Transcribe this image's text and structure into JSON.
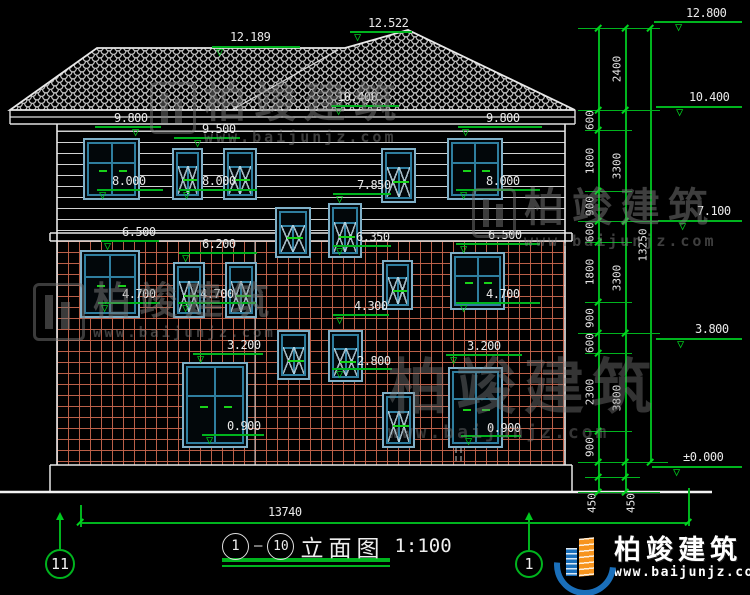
{
  "watermark": {
    "brand": "柏竣建筑",
    "url": "www.baijunjz.com"
  },
  "logo": {
    "brand": "柏竣建筑",
    "url": "www.baijunjz.com"
  },
  "title": {
    "axis_start": "1",
    "axis_end": "10",
    "name": "立面图",
    "scale": "1:100"
  },
  "axis_bubbles": {
    "left": "11",
    "right": "1"
  },
  "bottom_dimension": {
    "value": "13740"
  },
  "level_markers": [
    {
      "v": "12.522",
      "tx": 368,
      "ty": 16,
      "lx": 350,
      "lw": 62,
      "ly": 31,
      "dx": 354
    },
    {
      "v": "12.189",
      "tx": 230,
      "ty": 30,
      "lx": 212,
      "lw": 88,
      "ly": 46,
      "dx": 216
    },
    {
      "v": "10.400",
      "tx": 337,
      "ty": 90,
      "lx": 331,
      "lw": 68,
      "ly": 105,
      "dx": 335
    },
    {
      "v": "9.800",
      "tx": 114,
      "ty": 111,
      "lx": 95,
      "lw": 66,
      "ly": 126,
      "dx": 132
    },
    {
      "v": "9.500",
      "tx": 202,
      "ty": 122,
      "lx": 174,
      "lw": 66,
      "ly": 137,
      "dx": 194
    },
    {
      "v": "9.800",
      "tx": 486,
      "ty": 111,
      "lx": 458,
      "lw": 84,
      "ly": 126,
      "dx": 462
    },
    {
      "v": "8.000",
      "tx": 112,
      "ty": 174,
      "lx": 97,
      "lw": 66,
      "ly": 189,
      "dx": 99
    },
    {
      "v": "8.000",
      "tx": 202,
      "ty": 174,
      "lx": 179,
      "lw": 78,
      "ly": 189,
      "dx": 183
    },
    {
      "v": "8.000",
      "tx": 486,
      "ty": 174,
      "lx": 456,
      "lw": 84,
      "ly": 189,
      "dx": 460
    },
    {
      "v": "7.850",
      "tx": 357,
      "ty": 178,
      "lx": 333,
      "lw": 58,
      "ly": 193,
      "dx": 336
    },
    {
      "v": "6.500",
      "tx": 122,
      "ty": 225,
      "lx": 101,
      "lw": 58,
      "ly": 240,
      "dx": 104
    },
    {
      "v": "6.500",
      "tx": 488,
      "ty": 228,
      "lx": 456,
      "lw": 84,
      "ly": 243,
      "dx": 460
    },
    {
      "v": "6.200",
      "tx": 202,
      "ty": 237,
      "lx": 179,
      "lw": 78,
      "ly": 252,
      "dx": 182
    },
    {
      "v": "6.350",
      "tx": 356,
      "ty": 230,
      "lx": 333,
      "lw": 58,
      "ly": 245,
      "dx": 336
    },
    {
      "v": "4.700",
      "tx": 122,
      "ty": 287,
      "lx": 98,
      "lw": 62,
      "ly": 302,
      "dx": 101
    },
    {
      "v": "4.700",
      "tx": 200,
      "ty": 287,
      "lx": 178,
      "lw": 78,
      "ly": 302,
      "dx": 182
    },
    {
      "v": "4.700",
      "tx": 486,
      "ty": 287,
      "lx": 456,
      "lw": 84,
      "ly": 302,
      "dx": 460
    },
    {
      "v": "4.300",
      "tx": 354,
      "ty": 299,
      "lx": 333,
      "lw": 56,
      "ly": 314,
      "dx": 336
    },
    {
      "v": "3.200",
      "tx": 227,
      "ty": 338,
      "lx": 193,
      "lw": 70,
      "ly": 353,
      "dx": 197
    },
    {
      "v": "3.200",
      "tx": 467,
      "ty": 339,
      "lx": 446,
      "lw": 76,
      "ly": 354,
      "dx": 450
    },
    {
      "v": "2.800",
      "tx": 357,
      "ty": 354,
      "lx": 332,
      "lw": 60,
      "ly": 368,
      "dx": 336
    },
    {
      "v": "0.900",
      "tx": 227,
      "ty": 419,
      "lx": 202,
      "lw": 62,
      "ly": 434,
      "dx": 206
    },
    {
      "v": "0.900",
      "tx": 487,
      "ty": 421,
      "lx": 461,
      "lw": 60,
      "ly": 435,
      "dx": 465
    },
    {
      "v": "12.800",
      "tx": 686,
      "ty": 6,
      "lx": 654,
      "lw": 88,
      "ly": 21,
      "dx": 675
    },
    {
      "v": "10.400",
      "tx": 689,
      "ty": 90,
      "lx": 656,
      "lw": 86,
      "ly": 106,
      "dx": 676
    },
    {
      "v": "7.100",
      "tx": 697,
      "ty": 204,
      "lx": 658,
      "lw": 84,
      "ly": 220,
      "dx": 679
    },
    {
      "v": "3.800",
      "tx": 695,
      "ty": 322,
      "lx": 656,
      "lw": 86,
      "ly": 338,
      "dx": 677
    },
    {
      "v": "±0.000",
      "tx": 683,
      "ty": 450,
      "lx": 652,
      "lw": 90,
      "ly": 466,
      "dx": 673
    }
  ],
  "chain": {
    "vlines": [
      {
        "x": 598,
        "y1": 28,
        "y2": 492
      },
      {
        "x": 625,
        "y1": 28,
        "y2": 492
      },
      {
        "x": 650,
        "y1": 28,
        "y2": 462
      },
      {
        "x": 688,
        "y1": 488,
        "y2": 526
      },
      {
        "x": 80,
        "y1": 505,
        "y2": 526
      }
    ],
    "ticks": [
      {
        "y": 28,
        "x1": 578,
        "x2": 660
      },
      {
        "y": 110,
        "x1": 578,
        "x2": 660
      },
      {
        "y": 221,
        "x1": 578,
        "x2": 660
      },
      {
        "y": 333,
        "x1": 578,
        "x2": 660
      },
      {
        "y": 462,
        "x1": 578,
        "x2": 668
      },
      {
        "y": 492,
        "x1": 578,
        "x2": 660
      },
      {
        "y": 130,
        "x1": 585,
        "x2": 632
      },
      {
        "y": 191,
        "x1": 585,
        "x2": 632
      },
      {
        "y": 242,
        "x1": 585,
        "x2": 632
      },
      {
        "y": 302,
        "x1": 585,
        "x2": 632
      },
      {
        "y": 353,
        "x1": 585,
        "x2": 632
      },
      {
        "y": 431,
        "x1": 585,
        "x2": 632
      },
      {
        "y": 477,
        "x1": 585,
        "x2": 640
      }
    ],
    "slashes": {
      "v1": {
        "x": 598,
        "ys": [
          28,
          110,
          130,
          191,
          221,
          242,
          302,
          333,
          353,
          431,
          462,
          477,
          492
        ]
      },
      "v2": {
        "x": 625,
        "ys": [
          28,
          110,
          221,
          333,
          462,
          477,
          492
        ]
      },
      "v3": {
        "x": 650,
        "ys": [
          28,
          462
        ]
      }
    },
    "labels": [
      {
        "v": "600",
        "x": 590,
        "y": 120
      },
      {
        "v": "1800",
        "x": 590,
        "y": 161
      },
      {
        "v": "900",
        "x": 590,
        "y": 206
      },
      {
        "v": "600",
        "x": 590,
        "y": 232
      },
      {
        "v": "1800",
        "x": 590,
        "y": 272
      },
      {
        "v": "900",
        "x": 590,
        "y": 318
      },
      {
        "v": "600",
        "x": 590,
        "y": 343
      },
      {
        "v": "2300",
        "x": 590,
        "y": 392
      },
      {
        "v": "900",
        "x": 590,
        "y": 447
      },
      {
        "v": "2400",
        "x": 617,
        "y": 69
      },
      {
        "v": "3300",
        "x": 617,
        "y": 166
      },
      {
        "v": "3300",
        "x": 617,
        "y": 278
      },
      {
        "v": "3800",
        "x": 617,
        "y": 398
      },
      {
        "v": "13250",
        "x": 643,
        "y": 245
      },
      {
        "v": "450",
        "x": 592,
        "y": 503
      },
      {
        "v": "450",
        "x": 631,
        "y": 503
      }
    ]
  },
  "bottom_dim_geom": {
    "y": 522,
    "x1": 80,
    "x2": 688,
    "label_x": 268,
    "label_y": 505
  },
  "windows": [
    {
      "x": 83,
      "y": 138,
      "w": 57,
      "h": 62,
      "t": "A"
    },
    {
      "x": 172,
      "y": 148,
      "w": 31,
      "h": 52,
      "t": "B"
    },
    {
      "x": 223,
      "y": 148,
      "w": 34,
      "h": 52,
      "t": "B"
    },
    {
      "x": 381,
      "y": 148,
      "w": 35,
      "h": 55,
      "t": "B"
    },
    {
      "x": 447,
      "y": 138,
      "w": 56,
      "h": 62,
      "t": "A"
    },
    {
      "x": 275,
      "y": 207,
      "w": 36,
      "h": 51,
      "t": "B"
    },
    {
      "x": 328,
      "y": 203,
      "w": 34,
      "h": 55,
      "t": "B"
    },
    {
      "x": 80,
      "y": 250,
      "w": 60,
      "h": 68,
      "t": "A"
    },
    {
      "x": 173,
      "y": 262,
      "w": 32,
      "h": 56,
      "t": "B"
    },
    {
      "x": 225,
      "y": 262,
      "w": 32,
      "h": 56,
      "t": "B"
    },
    {
      "x": 382,
      "y": 260,
      "w": 31,
      "h": 50,
      "t": "B"
    },
    {
      "x": 450,
      "y": 252,
      "w": 55,
      "h": 58,
      "t": "A"
    },
    {
      "x": 182,
      "y": 362,
      "w": 66,
      "h": 86,
      "t": "A"
    },
    {
      "x": 277,
      "y": 330,
      "w": 33,
      "h": 50,
      "t": "B"
    },
    {
      "x": 328,
      "y": 330,
      "w": 35,
      "h": 52,
      "t": "B"
    },
    {
      "x": 382,
      "y": 392,
      "w": 33,
      "h": 56,
      "t": "B"
    },
    {
      "x": 448,
      "y": 367,
      "w": 55,
      "h": 81,
      "t": "A"
    }
  ],
  "watermarks_layout": [
    {
      "x": 150,
      "y": 82,
      "ts": 42,
      "us": 15,
      "op": 0.5,
      "logo": true,
      "lw": 46
    },
    {
      "x": 472,
      "y": 188,
      "ts": 40,
      "us": 15,
      "op": 0.5,
      "logo": true,
      "lw": 44
    },
    {
      "x": 33,
      "y": 283,
      "ts": 38,
      "us": 14,
      "op": 0.5,
      "logo": true,
      "lw": 52
    },
    {
      "x": 388,
      "y": 358,
      "ts": 60,
      "us": 18,
      "op": 0.42,
      "logo": false,
      "lw": 0
    }
  ]
}
